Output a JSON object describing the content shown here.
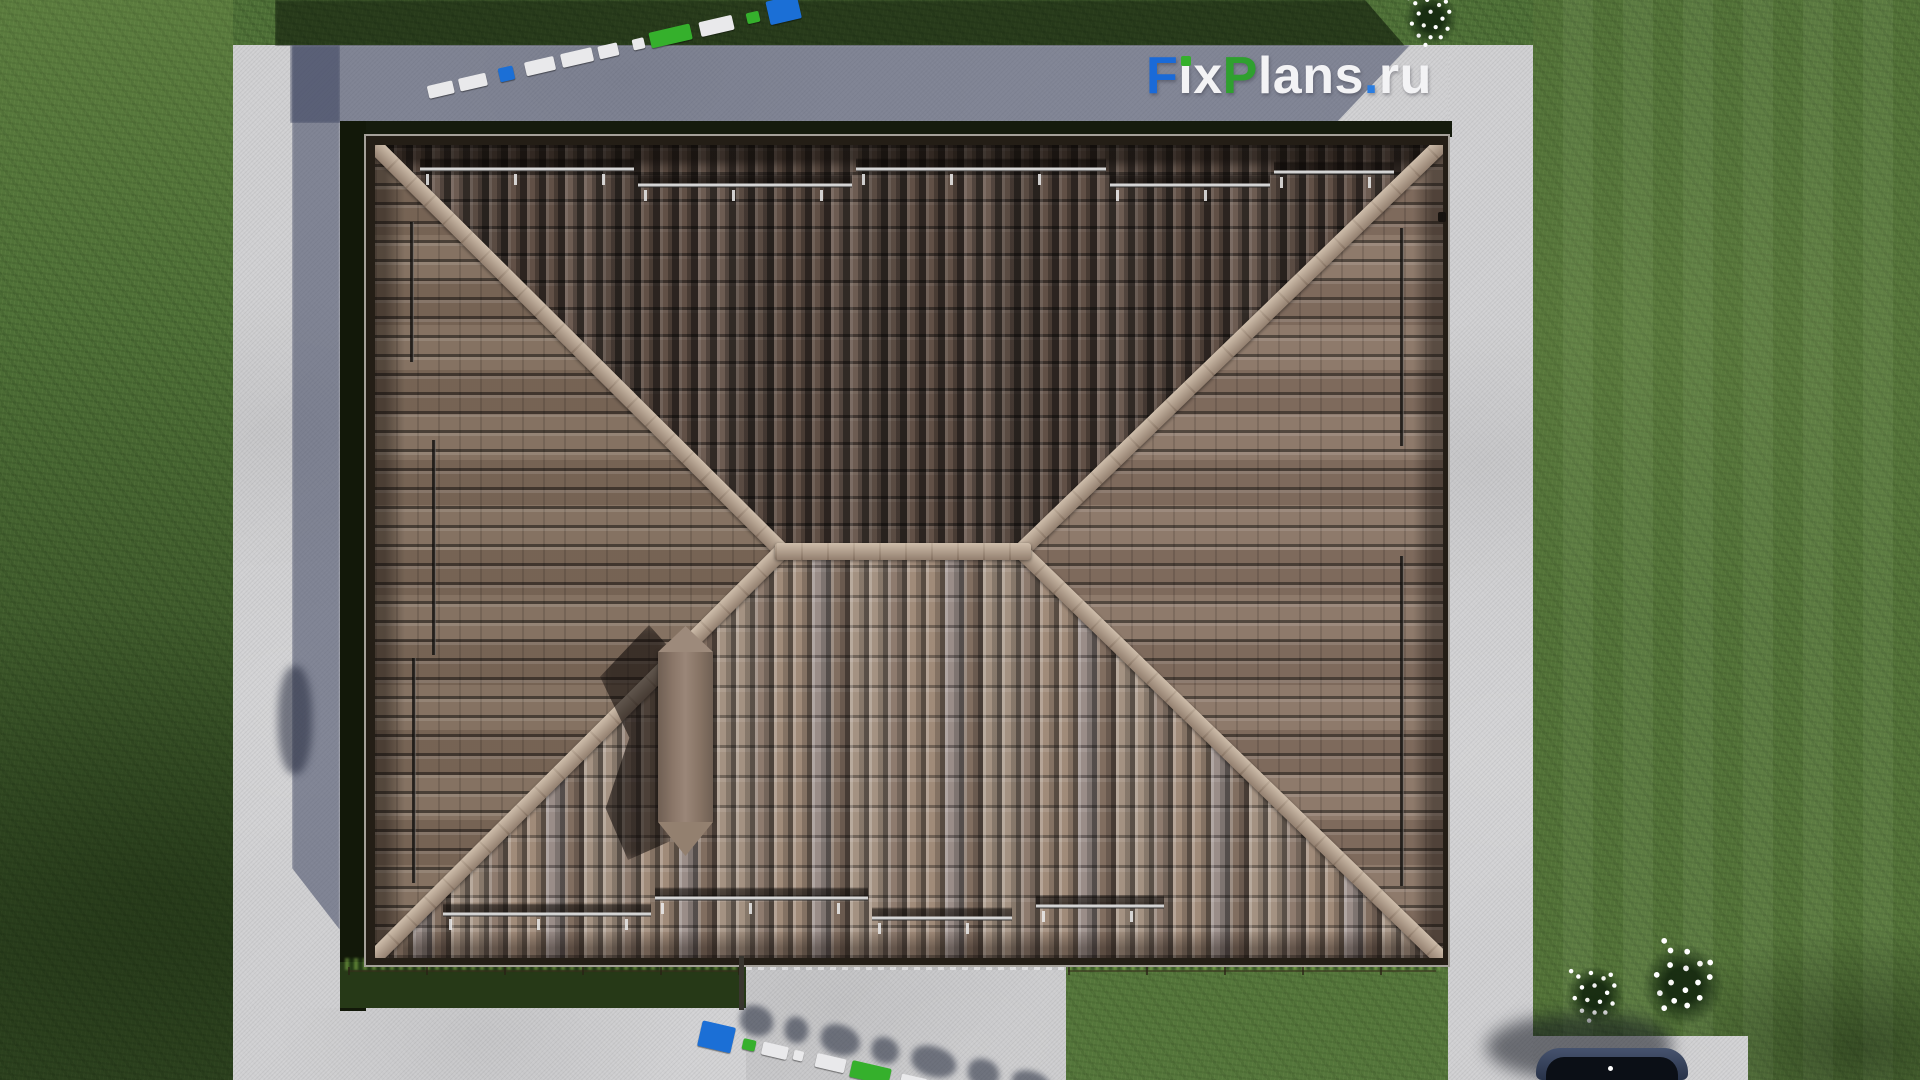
{
  "site": {
    "watermark_text": "FixPlans.ru"
  },
  "watermark": {
    "segments": [
      {
        "text": "F",
        "color": "#1a6ad8"
      },
      {
        "text": "ı",
        "color": "#f3f3f5"
      },
      {
        "text": "x",
        "color": "#f3f3f5"
      },
      {
        "text": "P",
        "color": "#2fa02f"
      },
      {
        "text": "lans",
        "color": "#f3f3f5"
      },
      {
        "text": ".",
        "color": "#2a7de1"
      },
      {
        "text": "ru",
        "color": "#f3f3f5"
      }
    ],
    "i_dot_color": "#35b02c"
  },
  "palette": {
    "grass": "#4e7037",
    "grass_shadow": "#151b0d",
    "concrete": "#cfcfd1",
    "concrete_shadow": "#8a90a2",
    "roof_top_plane": "#6a5a50",
    "roof_bottom_plane": "#9c8a7c",
    "roof_side_planes": "#857162",
    "roof_ridge_cap": "#b19e8d",
    "chimney": "#8d7a6c",
    "car": "#2e3a52",
    "flowers": "#ffffff",
    "brand_blue": "#1a6ad8",
    "brand_green": "#2fa02f"
  }
}
